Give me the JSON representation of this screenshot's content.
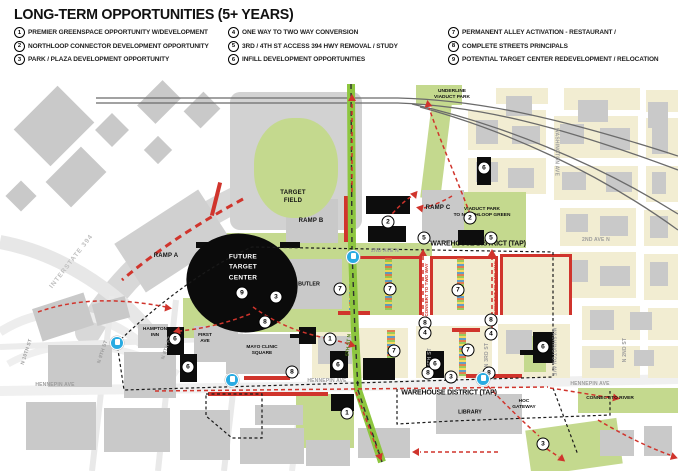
{
  "colors": {
    "accent_red": "#d0342c",
    "map_green": "#c4d98e",
    "block_cream": "#f2edd2",
    "rail_green": "#8dc63f",
    "transit_blue": "#29abe2",
    "ink": "#111111"
  },
  "header": {
    "title": "LONG-TERM OPPORTUNITIES (5+ YEARS)"
  },
  "legend": {
    "columns": [
      [
        {
          "n": "1",
          "label": "PREMIER GREENSPACE OPPORTUNITY W/DEVELOPMENT"
        },
        {
          "n": "2",
          "label": "NORTHLOOP CONNECTOR DEVELOPMENT OPPORTUNITY"
        },
        {
          "n": "3",
          "label": "PARK / PLAZA DEVELOPMENT OPPORTUNITY"
        }
      ],
      [
        {
          "n": "4",
          "label": "ONE WAY TO TWO WAY CONVERSION"
        },
        {
          "n": "5",
          "label": "3RD / 4TH ST ACCESS 394 HWY REMOVAL / STUDY"
        },
        {
          "n": "6",
          "label": "INFILL DEVELOPMENT OPPORTUNITIES"
        }
      ],
      [
        {
          "n": "7",
          "label": "PERMANENT ALLEY ACTIVATION - RESTAURANT /"
        },
        {
          "n": "8",
          "label": "COMPLETE STREETS PRINCIPALS"
        },
        {
          "n": "9",
          "label": "POTENTIAL TARGET CENTER REDEVELOPMENT / RELOCATION"
        }
      ]
    ]
  },
  "map": {
    "labels": [
      {
        "text": "INTERSTATE 394",
        "x": 72,
        "y": 262,
        "r": -52,
        "cls": "hwy",
        "name": "label-interstate-394"
      },
      {
        "text": "RAMP A",
        "x": 166,
        "y": 257,
        "cls": "place",
        "name": "label-ramp-a"
      },
      {
        "text": "RAMP B",
        "x": 311,
        "y": 222,
        "cls": "place",
        "name": "label-ramp-b"
      },
      {
        "text": "RAMP C",
        "x": 438,
        "y": 209,
        "cls": "place",
        "name": "label-ramp-c"
      },
      {
        "text": "TARGET\nFIELD",
        "x": 293,
        "y": 198,
        "cls": "place",
        "name": "label-target-field"
      },
      {
        "text": "FUTURE\nTARGET\nCENTER",
        "x": 243,
        "y": 268,
        "cls": "el-label",
        "name": "label-future-target-center"
      },
      {
        "text": "UNDERLINE\nVIADUCT PARK",
        "x": 452,
        "y": 95,
        "cls": "place-xs",
        "name": "label-underline-viaduct-park"
      },
      {
        "text": "VIADUCT PARK\nTO NORTHLOOP GREEN",
        "x": 482,
        "y": 213,
        "cls": "place-xs",
        "name": "label-viaduct-park-northloop"
      },
      {
        "text": "WASHINGTON AVE",
        "x": 556,
        "y": 152,
        "r": 90,
        "cls": "street",
        "name": "label-washington-ave-n"
      },
      {
        "text": "WASHINGTON AVE",
        "x": 553,
        "y": 352,
        "r": 90,
        "cls": "street",
        "name": "label-washington-ave-s"
      },
      {
        "text": "2ND AVE N",
        "x": 385,
        "y": 251,
        "cls": "street",
        "name": "label-2nd-ave-n-west"
      },
      {
        "text": "2ND AVE N",
        "x": 596,
        "y": 240,
        "cls": "street",
        "name": "label-2nd-ave-n-east"
      },
      {
        "text": "WAREHOUSE DISTRICT (TAP)",
        "x": 478,
        "y": 244,
        "cls": "tap",
        "name": "label-warehouse-district-north"
      },
      {
        "text": "WAREHOUSE DISTRICT (TAP)",
        "x": 449,
        "y": 393,
        "cls": "tap",
        "name": "label-warehouse-district-south"
      },
      {
        "text": "BUTLER",
        "x": 309,
        "y": 285,
        "cls": "place-sm",
        "name": "label-butler"
      },
      {
        "text": "FIRST\nAVE",
        "x": 205,
        "y": 339,
        "cls": "place-xs",
        "name": "label-first-ave"
      },
      {
        "text": "HAMPTON\nINN",
        "x": 155,
        "y": 333,
        "cls": "place-xs",
        "name": "label-hampton-inn"
      },
      {
        "text": "MAYO CLINIC\nSQUARE",
        "x": 262,
        "y": 351,
        "cls": "place-xs",
        "name": "label-mayo-clinic-square"
      },
      {
        "text": "HENNEPIN AVE",
        "x": 55,
        "y": 385,
        "cls": "street",
        "name": "label-hennepin-ave-west"
      },
      {
        "text": "HENNEPIN AVE",
        "x": 327,
        "y": 381,
        "cls": "street",
        "name": "label-hennepin-ave-center"
      },
      {
        "text": "HENNEPIN AVE",
        "x": 590,
        "y": 384,
        "cls": "street",
        "name": "label-hennepin-ave-east"
      },
      {
        "text": "LIBRARY",
        "x": 470,
        "y": 413,
        "cls": "place-sm",
        "name": "label-library"
      },
      {
        "text": "HOC\nGATEWAY",
        "x": 524,
        "y": 405,
        "cls": "place-xs",
        "name": "label-hoc-gateway"
      },
      {
        "text": "CONNECT TO RIVER",
        "x": 610,
        "y": 399,
        "cls": "place-xs",
        "name": "label-connect-to-river"
      },
      {
        "text": "N 10TH ST",
        "x": 27,
        "y": 352,
        "r": -72,
        "cls": "street",
        "name": "label-n-10th-st"
      },
      {
        "text": "N 9TH ST",
        "x": 103,
        "y": 352,
        "r": -72,
        "cls": "street",
        "name": "label-n-9th-st"
      },
      {
        "text": "N 8TH ST",
        "x": 167,
        "y": 348,
        "r": -72,
        "cls": "street",
        "name": "label-n-8th-st"
      },
      {
        "text": "5TH ST N",
        "x": 349,
        "y": 345,
        "r": -85,
        "cls": "rail-label",
        "name": "label-5th-st-n"
      },
      {
        "text": "N 4TH ST",
        "x": 430,
        "y": 360,
        "r": -90,
        "cls": "street",
        "name": "label-n-4th-st"
      },
      {
        "text": "N 3RD ST",
        "x": 487,
        "y": 355,
        "r": -90,
        "cls": "street",
        "name": "label-n-3rd-st"
      },
      {
        "text": "N 2ND ST",
        "x": 625,
        "y": 350,
        "r": -90,
        "cls": "street",
        "name": "label-n-2nd-st"
      },
      {
        "text": "CONVERT TO TWO WAY",
        "x": 427,
        "y": 290,
        "r": -90,
        "cls": "convert",
        "name": "label-convert-two-way-1"
      },
      {
        "text": "CONVERT TO TWO WAY",
        "x": 496,
        "y": 288,
        "r": -90,
        "cls": "convert",
        "name": "label-convert-two-way-2"
      }
    ],
    "markers": [
      {
        "n": "9",
        "x": 242,
        "y": 293
      },
      {
        "n": "3",
        "x": 276,
        "y": 297
      },
      {
        "n": "3",
        "x": 451,
        "y": 377
      },
      {
        "n": "3",
        "x": 543,
        "y": 444
      },
      {
        "n": "8",
        "x": 265,
        "y": 322
      },
      {
        "n": "8",
        "x": 292,
        "y": 372
      },
      {
        "n": "8",
        "x": 425,
        "y": 323
      },
      {
        "n": "8",
        "x": 491,
        "y": 320
      },
      {
        "n": "8",
        "x": 428,
        "y": 373
      },
      {
        "n": "8",
        "x": 489,
        "y": 373
      },
      {
        "n": "7",
        "x": 340,
        "y": 289
      },
      {
        "n": "7",
        "x": 390,
        "y": 289
      },
      {
        "n": "7",
        "x": 458,
        "y": 290
      },
      {
        "n": "7",
        "x": 394,
        "y": 351
      },
      {
        "n": "7",
        "x": 468,
        "y": 350
      },
      {
        "n": "2",
        "x": 388,
        "y": 222
      },
      {
        "n": "2",
        "x": 470,
        "y": 218
      },
      {
        "n": "5",
        "x": 424,
        "y": 238
      },
      {
        "n": "5",
        "x": 491,
        "y": 238
      },
      {
        "n": "1",
        "x": 330,
        "y": 339
      },
      {
        "n": "1",
        "x": 347,
        "y": 413
      },
      {
        "n": "4",
        "x": 425,
        "y": 333
      },
      {
        "n": "4",
        "x": 491,
        "y": 334
      },
      {
        "n": "6",
        "x": 484,
        "y": 168
      },
      {
        "n": "6",
        "x": 175,
        "y": 339
      },
      {
        "n": "6",
        "x": 188,
        "y": 367
      },
      {
        "n": "6",
        "x": 338,
        "y": 365
      },
      {
        "n": "6",
        "x": 435,
        "y": 364
      },
      {
        "n": "6",
        "x": 543,
        "y": 347
      }
    ],
    "transit_stops": [
      {
        "x": 117,
        "y": 343
      },
      {
        "x": 353,
        "y": 257
      },
      {
        "x": 232,
        "y": 380
      },
      {
        "x": 483,
        "y": 379
      }
    ]
  }
}
